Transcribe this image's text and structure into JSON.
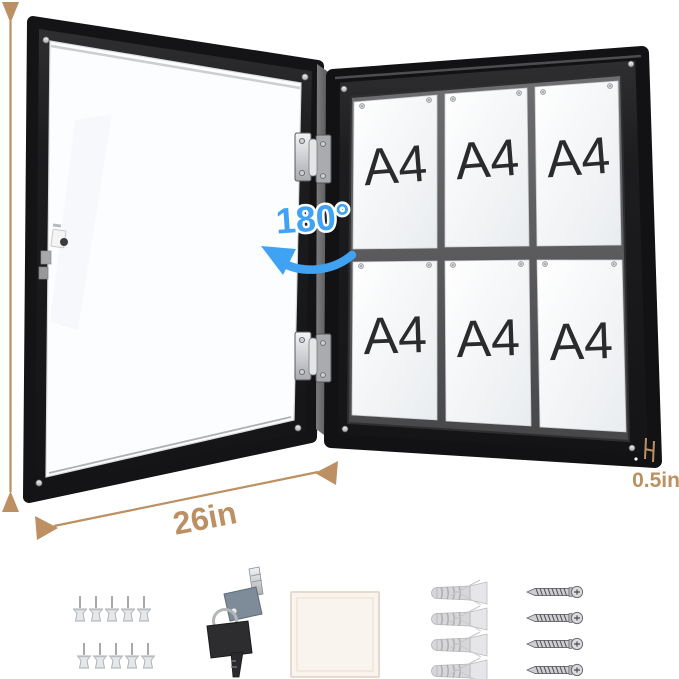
{
  "annotations": {
    "height_label": "28in",
    "width_label": "26in",
    "thickness_label": "0.5in",
    "swing_label": "180°"
  },
  "board": {
    "papers": [
      "A4",
      "A4",
      "A4",
      "A4",
      "A4",
      "A4"
    ],
    "paper_rows": 2,
    "paper_columns": 3,
    "pins_per_sheet": 2,
    "hinge_count": 2
  },
  "accessories": {
    "push_pins_count": 10,
    "keys_count": 2,
    "adhesive_pad_count": 1,
    "wall_anchors_count": 4,
    "screws_count": 4
  },
  "colors": {
    "dimension_annotation": "#BC9062",
    "swing_annotation": "#3FA2F2",
    "frame": "#1B1B1D",
    "board_backing": "#57575A",
    "paper": "#F4F6F8"
  }
}
